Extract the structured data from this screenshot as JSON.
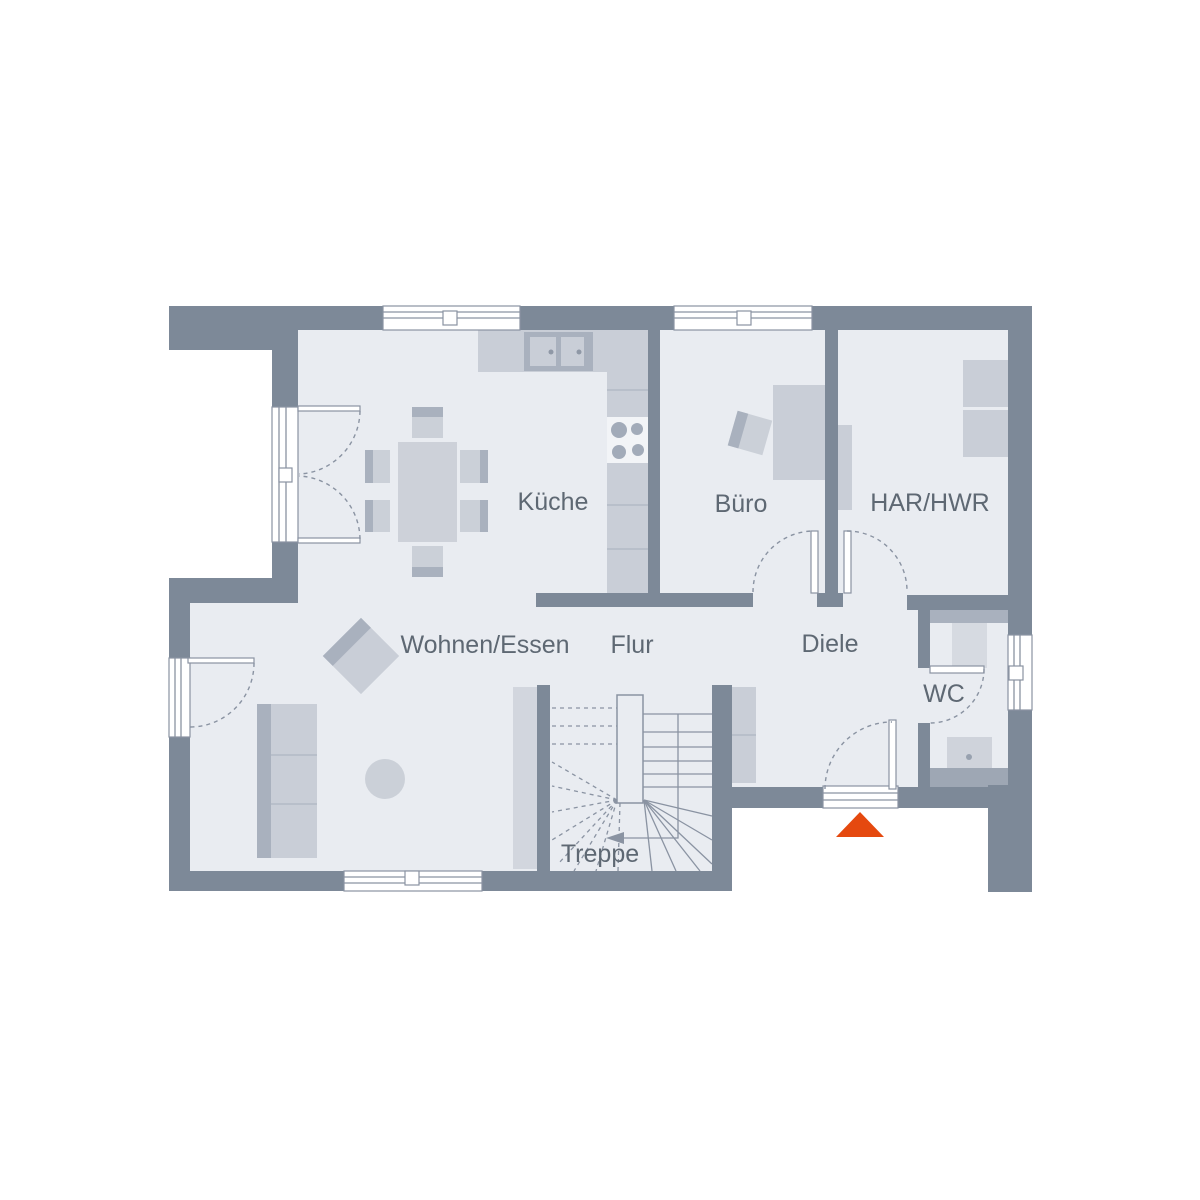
{
  "rooms": [
    {
      "id": "kueche",
      "label": "Küche"
    },
    {
      "id": "buero",
      "label": "Büro"
    },
    {
      "id": "har_hwr",
      "label": "HAR/HWR"
    },
    {
      "id": "wohnen_essen",
      "label": "Wohnen/Essen"
    },
    {
      "id": "flur",
      "label": "Flur"
    },
    {
      "id": "diele",
      "label": "Diele"
    },
    {
      "id": "wc",
      "label": "WC"
    },
    {
      "id": "treppe",
      "label": "Treppe"
    }
  ],
  "icons": {
    "entrance_marker": "triangle-up"
  },
  "colors": {
    "background": "#FFFFFF",
    "wall": "#7D8998",
    "floor": "#E9ECF1",
    "furniture": "#C9CED7",
    "furniture_dark": "#A9B1BE",
    "outline": "#8A93A2",
    "label": "#5E6873",
    "entrance_marker": "#E5490F"
  }
}
